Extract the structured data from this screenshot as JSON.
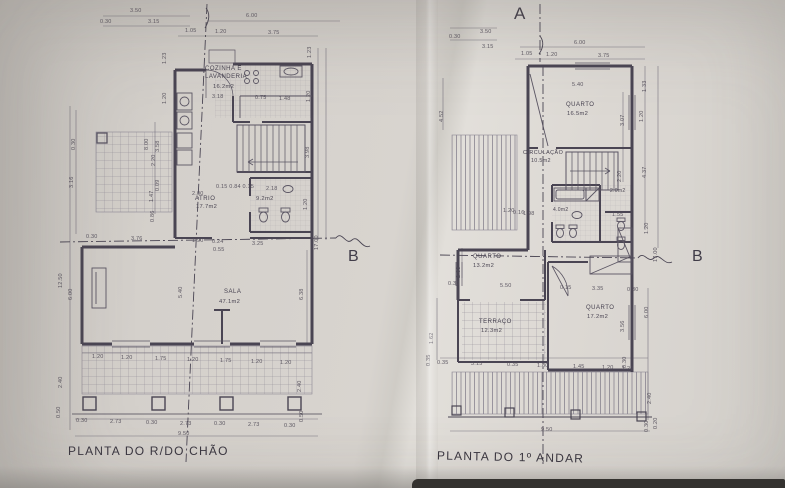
{
  "palette": {
    "paper": "#d8d4cf",
    "ink": "#4a4553",
    "ink_light": "#6a6574",
    "text": "#4c4754"
  },
  "section_markers": {
    "a": "A",
    "b_left": "B",
    "b_right": "B"
  },
  "ground_floor": {
    "caption": "PLANTA DO R/DO CHÃO",
    "rooms": [
      {
        "name": "COZINHA E\nLAVANDERIA",
        "area": "16.2m2"
      },
      {
        "name": "ATRIO",
        "area": "17.7m2"
      },
      {
        "name": "",
        "area": "9.2m2"
      },
      {
        "name": "SALA",
        "area": "47.1m2"
      }
    ],
    "dims": [
      {
        "t": "3.50",
        "x": 130,
        "y": 8
      },
      {
        "t": "0.30",
        "x": 100,
        "y": 19
      },
      {
        "t": "3.15",
        "x": 148,
        "y": 19
      },
      {
        "t": "6.00",
        "x": 246,
        "y": 13
      },
      {
        "t": "1.05",
        "x": 185,
        "y": 28
      },
      {
        "t": "1.20",
        "x": 215,
        "y": 29
      },
      {
        "t": "3.75",
        "x": 268,
        "y": 30
      },
      {
        "t": "3.18",
        "x": 212,
        "y": 94
      },
      {
        "t": "0.75",
        "x": 255,
        "y": 95
      },
      {
        "t": "1.48",
        "x": 279,
        "y": 96
      },
      {
        "t": "1.23",
        "x": 313,
        "y": 52,
        "r": 1
      },
      {
        "t": "1.20",
        "x": 312,
        "y": 96,
        "r": 1
      },
      {
        "t": "3.98",
        "x": 311,
        "y": 152,
        "r": 1
      },
      {
        "t": "1.20",
        "x": 309,
        "y": 204,
        "r": 1
      },
      {
        "t": "17.00",
        "x": 320,
        "y": 244,
        "r": 1
      },
      {
        "t": "1.23",
        "x": 168,
        "y": 58,
        "r": 1
      },
      {
        "t": "1.20",
        "x": 168,
        "y": 98,
        "r": 1
      },
      {
        "t": "8.00",
        "x": 150,
        "y": 144,
        "r": 1
      },
      {
        "t": "3.58",
        "x": 161,
        "y": 146,
        "r": 1
      },
      {
        "t": "2.20",
        "x": 157,
        "y": 160,
        "r": 1
      },
      {
        "t": "0.09",
        "x": 161,
        "y": 185,
        "r": 1
      },
      {
        "t": "1.47",
        "x": 155,
        "y": 196,
        "r": 1
      },
      {
        "t": "0.86",
        "x": 156,
        "y": 216,
        "r": 1
      },
      {
        "t": "0.30",
        "x": 77,
        "y": 144,
        "r": 1
      },
      {
        "t": "3.16",
        "x": 75,
        "y": 182,
        "r": 1
      },
      {
        "t": "12.50",
        "x": 64,
        "y": 282,
        "r": 1
      },
      {
        "t": "6.00",
        "x": 74,
        "y": 294,
        "r": 1
      },
      {
        "t": "0.15 0.84 0.15",
        "x": 216,
        "y": 184
      },
      {
        "t": "2.18",
        "x": 266,
        "y": 186
      },
      {
        "t": "2.00",
        "x": 192,
        "y": 191
      },
      {
        "t": "0.30",
        "x": 86,
        "y": 234
      },
      {
        "t": "3.76",
        "x": 131,
        "y": 236
      },
      {
        "t": "1.90",
        "x": 192,
        "y": 238
      },
      {
        "t": "0.24",
        "x": 212,
        "y": 239
      },
      {
        "t": "3.25",
        "x": 252,
        "y": 241
      },
      {
        "t": "0.55",
        "x": 213,
        "y": 247
      },
      {
        "t": "5.40",
        "x": 184,
        "y": 292,
        "r": 1
      },
      {
        "t": "6.38",
        "x": 305,
        "y": 294,
        "r": 1
      },
      {
        "t": "1.20",
        "x": 92,
        "y": 354
      },
      {
        "t": "1.20",
        "x": 121,
        "y": 355
      },
      {
        "t": "1.75",
        "x": 155,
        "y": 356
      },
      {
        "t": "1.20",
        "x": 187,
        "y": 357
      },
      {
        "t": "1.75",
        "x": 220,
        "y": 358
      },
      {
        "t": "1.20",
        "x": 251,
        "y": 359
      },
      {
        "t": "1.20",
        "x": 280,
        "y": 360
      },
      {
        "t": "2.40",
        "x": 64,
        "y": 382,
        "r": 1
      },
      {
        "t": "0.50",
        "x": 62,
        "y": 412,
        "r": 1
      },
      {
        "t": "2.40",
        "x": 303,
        "y": 386,
        "r": 1
      },
      {
        "t": "0.50",
        "x": 305,
        "y": 416,
        "r": 1
      },
      {
        "t": "0.30",
        "x": 76,
        "y": 418
      },
      {
        "t": "2.73",
        "x": 110,
        "y": 419
      },
      {
        "t": "0.30",
        "x": 146,
        "y": 420
      },
      {
        "t": "2.73",
        "x": 180,
        "y": 421
      },
      {
        "t": "0.30",
        "x": 214,
        "y": 421
      },
      {
        "t": "2.73",
        "x": 248,
        "y": 422
      },
      {
        "t": "0.30",
        "x": 284,
        "y": 423
      },
      {
        "t": "9.50",
        "x": 178,
        "y": 431
      }
    ]
  },
  "first_floor": {
    "caption": "PLANTA DO 1º ANDAR",
    "rooms": [
      {
        "name": "QUARTO",
        "area": "16.5m2"
      },
      {
        "name": "CIRCULAÇÃO",
        "area": "10.5m2"
      },
      {
        "name": "",
        "area": "4.0m2"
      },
      {
        "name": "",
        "area": "2.0m2"
      },
      {
        "name": "QUARTO",
        "area": "13.2m2"
      },
      {
        "name": "TERRAÇO",
        "area": "12.3m2"
      },
      {
        "name": "QUARTO",
        "area": "17.2m2"
      }
    ],
    "dims": [
      {
        "t": "3.50",
        "x": 480,
        "y": 29
      },
      {
        "t": "0.30",
        "x": 449,
        "y": 34
      },
      {
        "t": "3.15",
        "x": 482,
        "y": 44
      },
      {
        "t": "6.00",
        "x": 574,
        "y": 40
      },
      {
        "t": "1.05",
        "x": 521,
        "y": 51
      },
      {
        "t": "1.20",
        "x": 546,
        "y": 52
      },
      {
        "t": "3.75",
        "x": 598,
        "y": 53
      },
      {
        "t": "5.40",
        "x": 572,
        "y": 82
      },
      {
        "t": "1.33",
        "x": 648,
        "y": 86,
        "r": 1
      },
      {
        "t": "1.20",
        "x": 645,
        "y": 116,
        "r": 1
      },
      {
        "t": "3.07",
        "x": 626,
        "y": 120,
        "r": 1
      },
      {
        "t": "4.52",
        "x": 445,
        "y": 116,
        "r": 1
      },
      {
        "t": "4.37",
        "x": 648,
        "y": 172,
        "r": 1
      },
      {
        "t": "2.20",
        "x": 623,
        "y": 176,
        "r": 1
      },
      {
        "t": "1.20",
        "x": 650,
        "y": 228,
        "r": 1
      },
      {
        "t": "17.00",
        "x": 659,
        "y": 256,
        "r": 1
      },
      {
        "t": "1.20",
        "x": 503,
        "y": 208
      },
      {
        "t": "0.16",
        "x": 513,
        "y": 210
      },
      {
        "t": "1.98",
        "x": 523,
        "y": 211
      },
      {
        "t": "1.55",
        "x": 612,
        "y": 212
      },
      {
        "t": "2.88",
        "x": 462,
        "y": 272,
        "r": 1
      },
      {
        "t": "0.30",
        "x": 448,
        "y": 281
      },
      {
        "t": "5.50",
        "x": 500,
        "y": 283
      },
      {
        "t": "0.15",
        "x": 560,
        "y": 285
      },
      {
        "t": "3.35",
        "x": 592,
        "y": 286
      },
      {
        "t": "0.30",
        "x": 627,
        "y": 287
      },
      {
        "t": "6.00",
        "x": 650,
        "y": 312,
        "r": 1
      },
      {
        "t": "3.56",
        "x": 626,
        "y": 326,
        "r": 1
      },
      {
        "t": "0.30",
        "x": 628,
        "y": 362,
        "r": 1
      },
      {
        "t": "1.62",
        "x": 435,
        "y": 338,
        "r": 1
      },
      {
        "t": "0.35",
        "x": 432,
        "y": 360,
        "r": 1
      },
      {
        "t": "0.35",
        "x": 437,
        "y": 360
      },
      {
        "t": "3.15",
        "x": 471,
        "y": 361
      },
      {
        "t": "0.35",
        "x": 507,
        "y": 362
      },
      {
        "t": "1.80",
        "x": 537,
        "y": 363
      },
      {
        "t": "1.45",
        "x": 573,
        "y": 364
      },
      {
        "t": "1.20",
        "x": 602,
        "y": 365
      },
      {
        "t": "1.20",
        "x": 622,
        "y": 366
      },
      {
        "t": "2.40",
        "x": 653,
        "y": 398,
        "r": 1
      },
      {
        "t": "0.30",
        "x": 650,
        "y": 426,
        "r": 1
      },
      {
        "t": "0.20",
        "x": 659,
        "y": 423,
        "r": 1
      },
      {
        "t": "9.50",
        "x": 541,
        "y": 427
      }
    ]
  }
}
